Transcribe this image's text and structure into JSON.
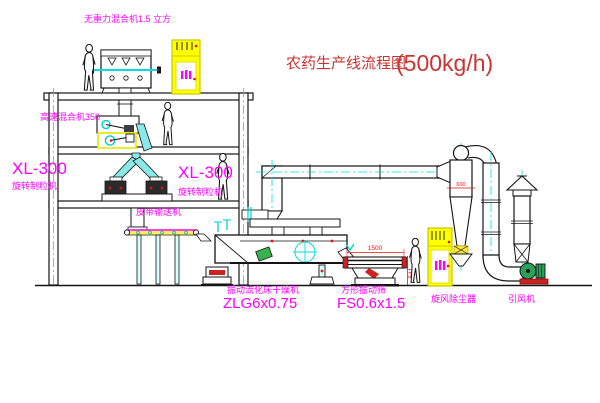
{
  "title": {
    "name": "农药生产线流程图",
    "capacity": "(500kg/h)"
  },
  "labels": {
    "gravity_mixer": "无重力混合机1.5 立方",
    "high_speed_mixer": "高速混合机350",
    "xl300_left": "XL-300",
    "granulator_left": "旋转制粒机",
    "xl300_mid": "XL-300",
    "granulator_mid": "旋转制粒机",
    "belt_conveyor": "皮带输送机",
    "dryer_name": "振动流化床干燥机",
    "dryer_model": "ZLG6x0.75",
    "sieve_name": "方形振动筛",
    "sieve_model": "FS0.6x1.5",
    "cyclone": "旋风除尘器",
    "fan": "引风机"
  },
  "dimensions": {
    "sieve_length": "1500",
    "sieve_height": "541",
    "cyclone_width": "600"
  },
  "colors": {
    "label_magenta": "#ff00ff",
    "title_red": "#cc3333",
    "dimension_red": "#ee1111",
    "centerline_cyan": "#00dede",
    "cabinet_yellow": "#ffff00",
    "chute_cyan": "#8ae8e8",
    "fan_green": "#2aa05a",
    "conveyor_yellow": "#ffef60",
    "line_black": "#141414"
  }
}
